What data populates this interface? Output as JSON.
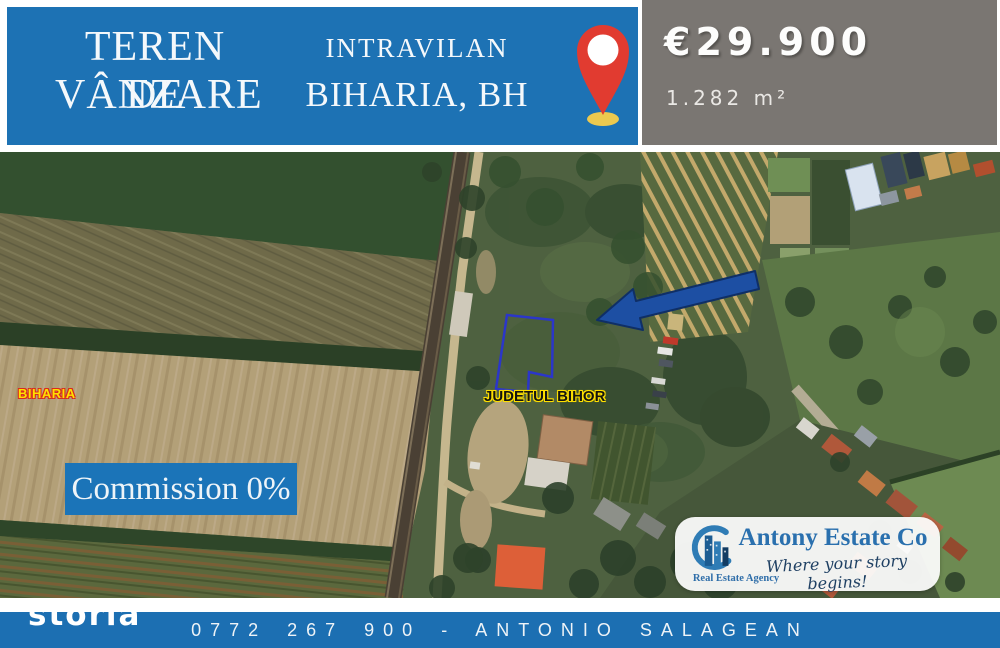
{
  "header": {
    "title_line1": "TEREN DE",
    "title_line2": "VÂNZARE",
    "subtitle_line1": "INTRAVILAN",
    "subtitle_line2": "BIHARIA, BH",
    "pin_icon": "location-pin-icon",
    "banner_color": "#1d72b4"
  },
  "price_panel": {
    "price": "€29.900",
    "area": "1.282 m²",
    "background_color": "#7a7672"
  },
  "map": {
    "town_label": "BIHARIA",
    "county_label": "JUDETUL BIHOR",
    "commission_badge": "Commission 0%",
    "plot_outline_color": "#2b36c9",
    "arrow_icon": "left-arrow-icon",
    "arrow_color": "#1d4fa3"
  },
  "agency": {
    "name": "Antony Estate Co",
    "tagline": "Where your story begins!",
    "type_label": "Real Estate Agency",
    "logo_icon": "buildings-swoosh-icon",
    "accent_color": "#2a70ae"
  },
  "footer": {
    "watermark": "storia",
    "contact": "0772 267 900 - ANTONIO SALAGEAN",
    "bar_color": "#1c6fb2"
  }
}
